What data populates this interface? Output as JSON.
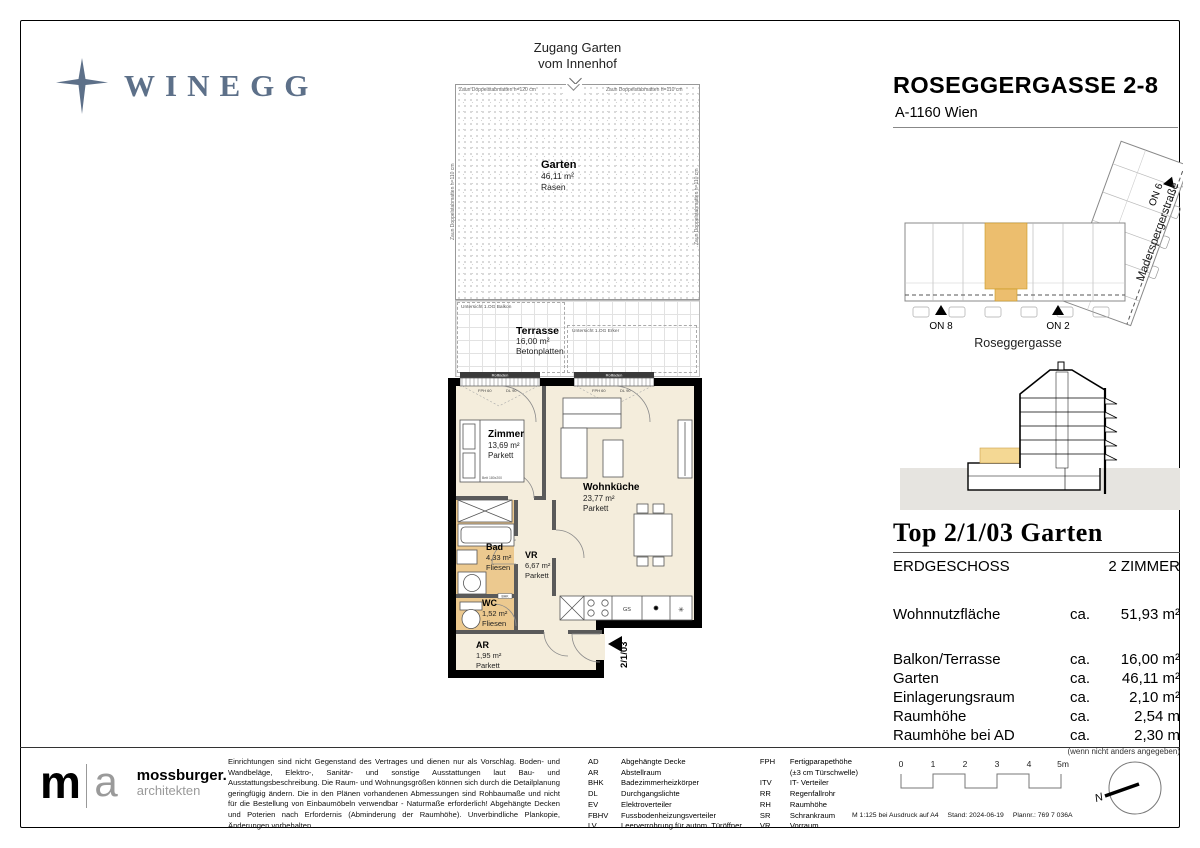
{
  "page": {
    "brand": "WINEGG",
    "project": "ROSEGGERGASSE 2-8",
    "city": "A-1160 Wien"
  },
  "colors": {
    "brand": "#5d7089",
    "unit_highlight": "#ecbe6e",
    "floor_beige": "#f4eddc",
    "tile_tan": "#ecc98f",
    "section_orange": "#e9b95b",
    "section_orange_light": "#f4d894",
    "ground_gray": "#e6e4e0"
  },
  "plan": {
    "access_line1": "Zugang Garten",
    "access_line2": "vom Innenhof",
    "garden": {
      "name": "Garten",
      "area": "46,11 m²",
      "surface": "Rasen"
    },
    "fence_top_left": "Zaun Doppelstabmatten h=120 cm",
    "fence_top_right": "Zaun Doppelstabmatten h=110 cm",
    "fence_left": "Zaun Doppelstabmatten h=110 cm",
    "fence_right": "Zaun Doppelstabmatten h=110 cm",
    "terrace": {
      "name": "Terrasse",
      "area": "16,00 m²",
      "surface": "Betonplatten"
    },
    "untersicht_balkon": "Untersicht 1.OG Balkon",
    "untersicht_erker": "Untersicht 1.OG Erker",
    "rooms": [
      {
        "name": "Zimmer",
        "area": "13,69 m²",
        "surface": "Parkett"
      },
      {
        "name": "Wohnküche",
        "area": "23,77 m²",
        "surface": "Parkett"
      },
      {
        "name": "Bad",
        "area": "4,33 m²",
        "surface": "Fliesen"
      },
      {
        "name": "VR",
        "area": "6,67 m²",
        "surface": "Parkett"
      },
      {
        "name": "WC",
        "area": "1,52 m²",
        "surface": "Fliesen"
      },
      {
        "name": "AR",
        "area": "1,95 m²",
        "surface": "Parkett"
      }
    ],
    "bed_label": "Bett 180x200",
    "bhk_label": "BHK",
    "gs_label": "GS",
    "rollladen": "Rollladen",
    "win_fph": "FPH 60",
    "win_dl": "DL 90",
    "unit_marker": "2/1/03"
  },
  "site": {
    "street_bottom": "Roseggergasse",
    "street_right": "Maderspergerstraße",
    "on8": "ON 8",
    "on2": "ON 2",
    "on6": "ON 6"
  },
  "unit": {
    "title": "Top 2/1/03 Garten",
    "floor": "ERDGESCHOSS",
    "rooms": "2 ZIMMER",
    "rows": [
      {
        "label": "Wohnnutzfläche",
        "ca": "ca.",
        "value": "51,93 m²"
      },
      {
        "label": "Balkon/Terrasse",
        "ca": "ca.",
        "value": "16,00 m²"
      },
      {
        "label": "Garten",
        "ca": "ca.",
        "value": "46,11 m²"
      },
      {
        "label": "Einlagerungsraum",
        "ca": "ca.",
        "value": "2,10 m²"
      },
      {
        "label": "Raumhöhe",
        "ca": "ca.",
        "value": "2,54 m"
      },
      {
        "label": "Raumhöhe bei AD",
        "ca": "ca.",
        "value": "2,30 m"
      }
    ],
    "note": "(wenn nicht anders angegeben)"
  },
  "footer": {
    "logo": {
      "m": "m",
      "a": "a",
      "name": "mossburger.",
      "sub": "architekten"
    },
    "disclaimer": "Einrichtungen sind nicht Gegenstand des Vertrages und dienen nur als Vorschlag. Boden- und Wandbeläge, Elektro-, Sanitär- und sonstige Ausstattungen laut Bau- und Ausstattungsbeschreibung. Die Raum- und Wohnungsgrößen können sich durch die Detailplanung geringfügig ändern. Die in den Plänen vorhandenen Abmessungen sind Rohbaumaße und nicht für die Bestellung von Einbaumöbeln verwendbar - Naturmaße erforderlich! Abgehängte Decken und Poterien nach Erfordernis (Abminderung der Raumhöhe). Unverbindliche Plankopie, Änderungen vorbehalten.",
    "legend_left": [
      {
        "abbr": "AD",
        "term": "Abgehängte Decke"
      },
      {
        "abbr": "AR",
        "term": "Abstellraum"
      },
      {
        "abbr": "BHK",
        "term": "Badezimmerheizkörper"
      },
      {
        "abbr": "DL",
        "term": "Durchgangslichte"
      },
      {
        "abbr": "EV",
        "term": "Elektroverteiler"
      },
      {
        "abbr": "FBHV",
        "term": "Fussbodenheizungsverteiler"
      },
      {
        "abbr": "LV",
        "term": "Leerverrohrung für autom. Türöffner"
      }
    ],
    "legend_right": [
      {
        "abbr": "FPH",
        "term": "Fertigparapethöhe"
      },
      {
        "abbr": "",
        "term": "(±3 cm Türschwelle)"
      },
      {
        "abbr": "ITV",
        "term": "IT- Verteiler"
      },
      {
        "abbr": "RR",
        "term": "Regenfallrohr"
      },
      {
        "abbr": "RH",
        "term": "Raumhöhe"
      },
      {
        "abbr": "SR",
        "term": "Schrankraum"
      },
      {
        "abbr": "VR",
        "term": "Vorraum"
      }
    ],
    "scale_ticks": [
      "0",
      "1",
      "2",
      "3",
      "4",
      "5m"
    ],
    "north_label": "N",
    "print": {
      "scale": "M 1:125 bei Ausdruck auf A4",
      "stand": "Stand: 2024-06-19",
      "plannr": "Plannr.: 769 7 036A"
    }
  }
}
